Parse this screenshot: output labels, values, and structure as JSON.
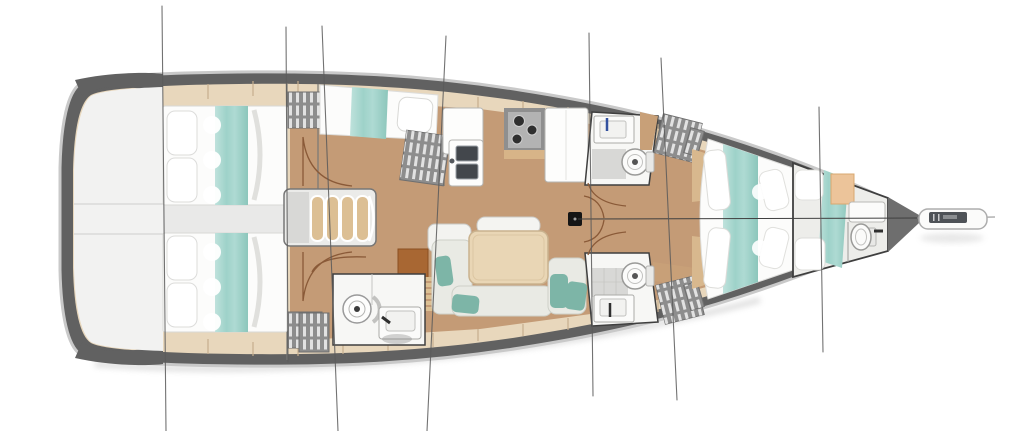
{
  "drawing": {
    "kind": "sailing-yacht-interior-deck-plan",
    "orientation": "bow-right-stern-left",
    "visible_text": [],
    "components": [
      "transom-cockpit",
      "aft-cabin-top",
      "aft-cabin-bottom",
      "single-berth-cabin-top",
      "companionway-steps",
      "engine-box",
      "galley",
      "salon-table-and-sofa",
      "bathroom-bottom-left",
      "head-top-right",
      "head-bottom-right",
      "bow-cabin",
      "forepeak-compartment",
      "anchor-locker",
      "bowsprit",
      "mast",
      "rigging-lines",
      "centerline"
    ],
    "icons": {
      "toilet-icon": "circle-with-inner-ring-and-dot",
      "shower-icon": "circle-with-ring-and-center-drain",
      "washbasin-icon": "rect-with-inner-basin-and-faucet",
      "stove-icon": "recessed-panel-with-three-burners",
      "double-sink-icon": "two-dark-square-basins",
      "mast-icon": "solid-black-square",
      "hanging-locker-icon": "grey-block-with-white-louvre-slats",
      "steps-icon": "four-curved-treads"
    }
  },
  "colors": {
    "bg": "#ffffff",
    "hull": "#616161",
    "rim": "#c9c9c9",
    "deck": "#e8d7bc",
    "seam": "#c6ae8e",
    "floor": "#c49b76",
    "cockpit": "#f2f2f1",
    "room": "#f7f7f5",
    "bed": "#fcfcfb",
    "outline": "#3f3f3f",
    "locker": "#8d8d8d",
    "slat": "#ececeb",
    "teal_light": "#bfe2dc",
    "teal": "#9ed2c9",
    "teal_deep": "#8cc6bb",
    "pillow_teal": "#7db5a7",
    "table": "#e9d6b5",
    "step": "#dcbf94",
    "trim": "#d7b488",
    "sienna": "#a86733",
    "sink_dark": "#43474c",
    "tile": "#d8d8d6",
    "peach": "#ecc49a",
    "mast": "#151515",
    "rig": "#5a5a5a",
    "door": "#8a5a38",
    "faucet_blue": "#33519e",
    "bow_dark": "#6e6e6e",
    "bowsprit_dark": "#4e5257",
    "shadow": "#9a9a9a"
  }
}
